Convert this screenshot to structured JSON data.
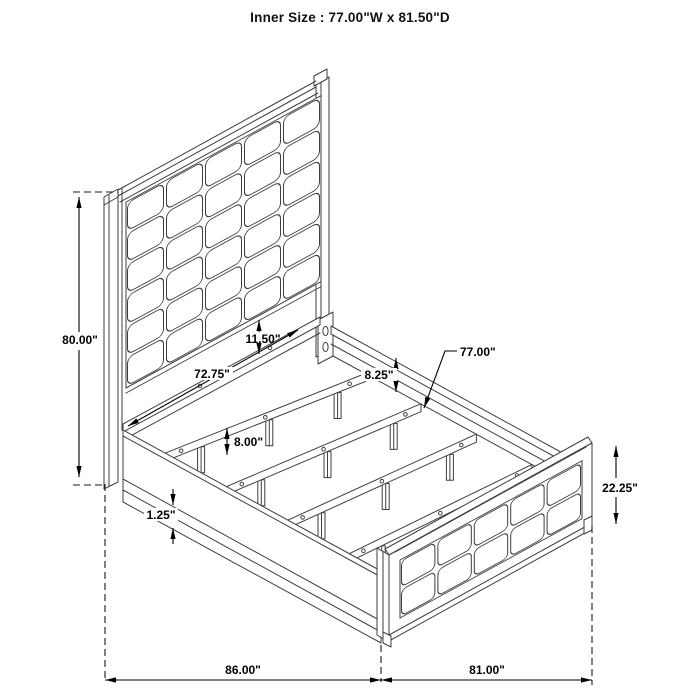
{
  "title": "Inner Size : 77.00\"W x 81.50\"D",
  "dimensions": {
    "headboard_height": "80.00\"",
    "panel_to_rail_gap": "11.50\"",
    "post_inner_width": "72.75\"",
    "rail_to_slat_drop": "8.25\"",
    "slat_length": "77.00\"",
    "slat_leg_height": "8.00\"",
    "rail_bottom_lip": "1.25\"",
    "footboard_height": "22.25\"",
    "overall_length": "86.00\"",
    "overall_width": "81.00\""
  },
  "figure": {
    "type": "isometric-line-drawing",
    "subject": "upholstered panel bed frame with slat system",
    "headboard_grid": {
      "cols": 5,
      "rows": 6
    },
    "footboard_grid": {
      "cols": 5,
      "rows": 2
    },
    "slat_count": 4,
    "legs_per_slat": 3,
    "holes_per_slat": 3,
    "colors": {
      "line": "#3e3e3e",
      "dimension": "#000000",
      "background": "#ffffff"
    }
  }
}
